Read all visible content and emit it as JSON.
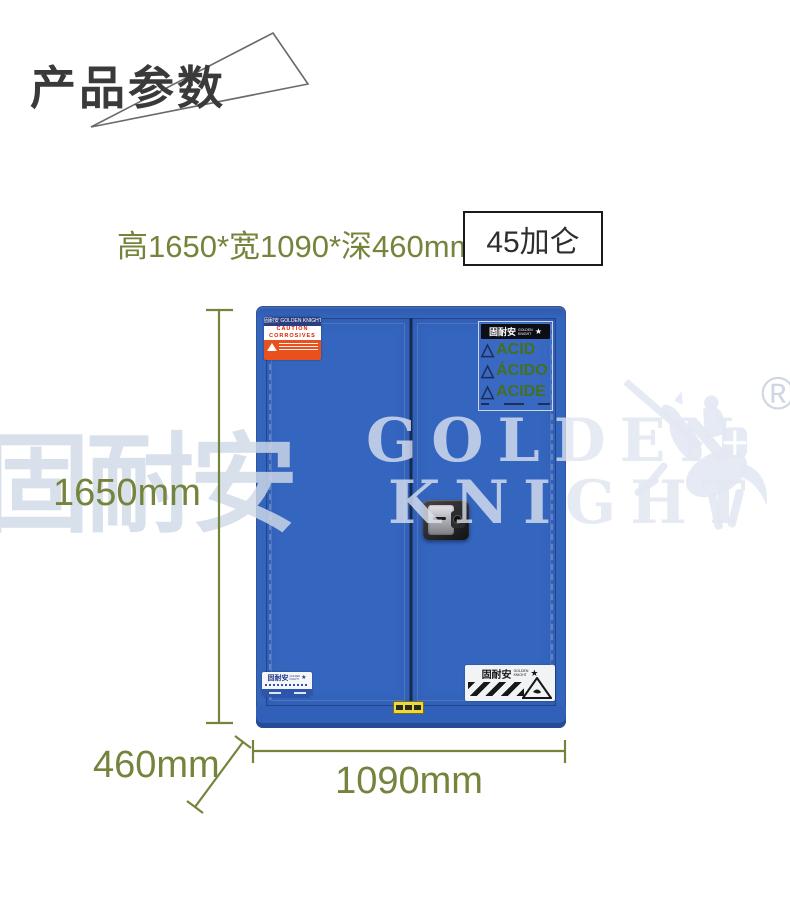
{
  "header": {
    "title": "产品参数"
  },
  "specs": {
    "size_text": "高1650*宽1090*深460mm",
    "capacity": "45加仑"
  },
  "watermark": {
    "cjk": "固耐安",
    "word1": "GOLDEN",
    "word2": "KNIGHT",
    "registered": "®"
  },
  "cabinet": {
    "blue": "#3465bd",
    "caution_label": {
      "brand": "固耐安 GOLDEN KNIGHT",
      "line1": "CAUTION",
      "line2": "CORROSIVES"
    },
    "acid_label": {
      "brand_cjk": "固耐安",
      "brand_en1": "GOLDEN",
      "brand_en2": "KNIGHT",
      "items": [
        "ACID",
        "ÁCIDO",
        "ACIDE"
      ]
    },
    "bottom_left_label": {
      "brand_cjk": "固耐安",
      "brand_en1": "GOLDEN",
      "brand_en2": "KNIGHT"
    },
    "bottom_right_label": {
      "brand_cjk": "固耐安",
      "brand_en1": "GOLDEN",
      "brand_en2": "KNIGHT"
    }
  },
  "icons": {
    "warning_triangle": "△",
    "knight_star": "★"
  },
  "annotations": {
    "height": "1650mm",
    "width": "1090mm",
    "depth": "460mm",
    "accent_color": "#75843c"
  }
}
